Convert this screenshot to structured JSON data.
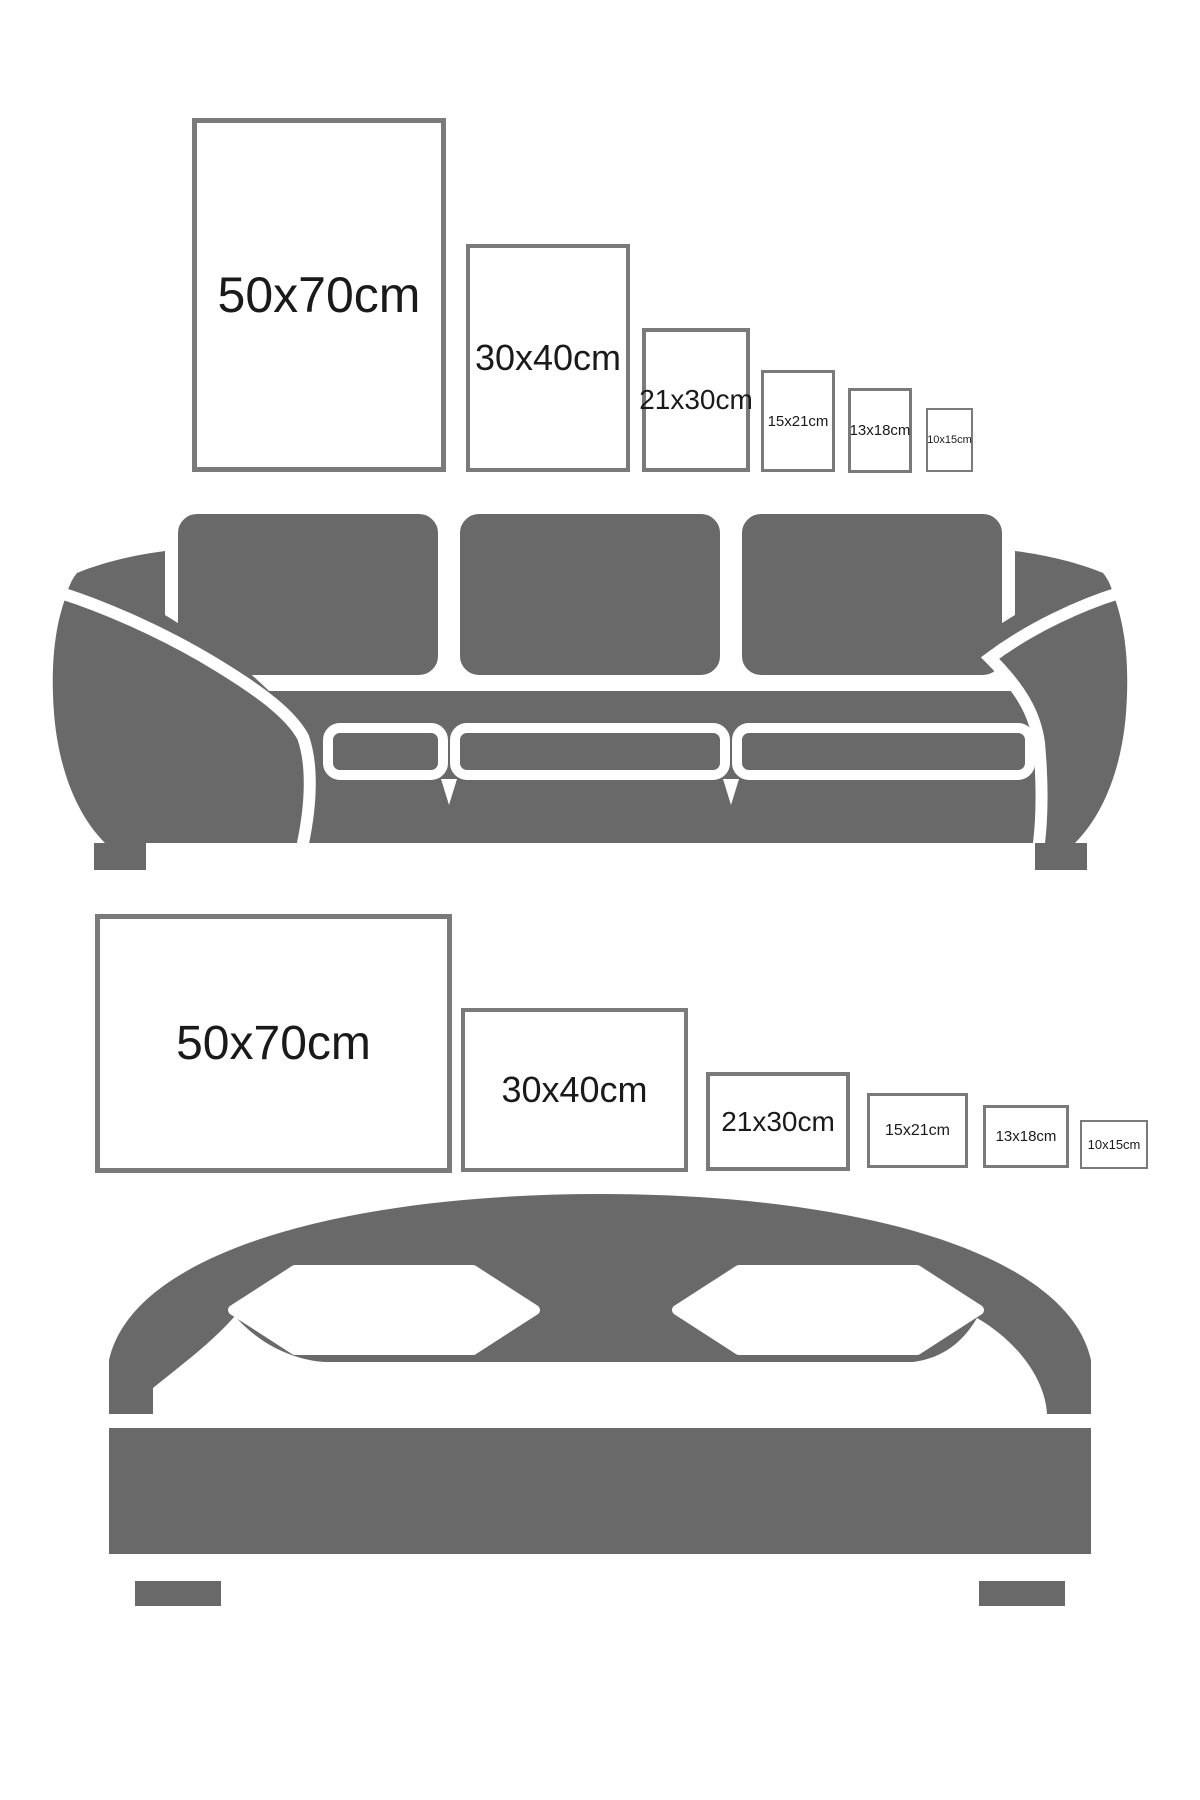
{
  "title": "Poster size guide above sofa and bed",
  "colors": {
    "background": "#ffffff",
    "furniture": "#696969",
    "frame_border": "#7a7a7a",
    "text": "#1a1a1a"
  },
  "sections": {
    "sofa": {
      "furniture": "sofa",
      "orientation": "portrait",
      "frames": [
        {
          "label": "50x70cm"
        },
        {
          "label": "30x40cm"
        },
        {
          "label": "21x30cm"
        },
        {
          "label": "15x21cm"
        },
        {
          "label": "13x18cm"
        },
        {
          "label": "10x15cm"
        }
      ]
    },
    "bed": {
      "furniture": "bed",
      "orientation": "landscape",
      "frames": [
        {
          "label": "50x70cm"
        },
        {
          "label": "30x40cm"
        },
        {
          "label": "21x30cm"
        },
        {
          "label": "15x21cm"
        },
        {
          "label": "13x18cm"
        },
        {
          "label": "10x15cm"
        }
      ]
    }
  }
}
